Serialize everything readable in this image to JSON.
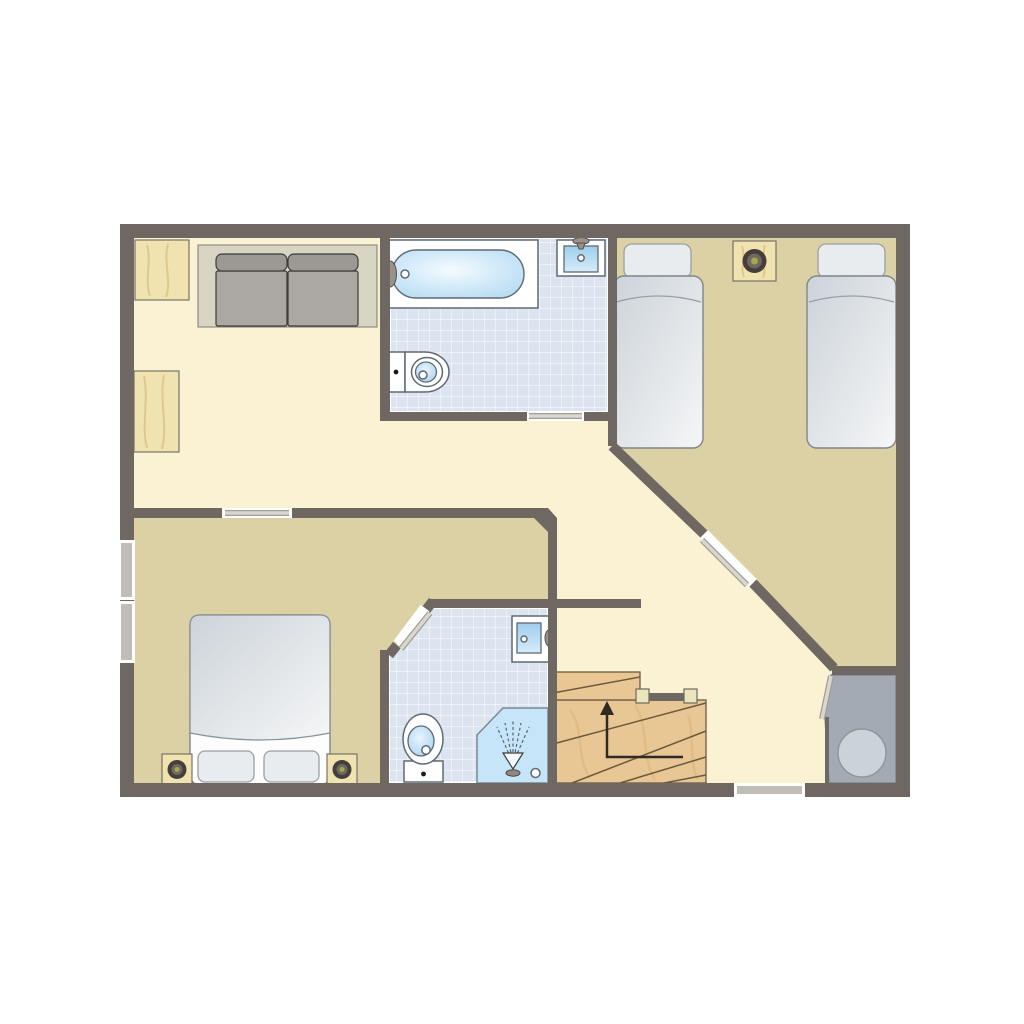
{
  "diagram": {
    "type": "floor-plan",
    "label": "apartment-floor-plan",
    "visible_text": "none"
  },
  "palette": {
    "background": "#ffffff",
    "wall": "#6f6862",
    "floor_hall": "#fbf2d3",
    "floor_bedroom": "#dcd1a5",
    "floor_bath_tile": "#dce4f0",
    "floor_utility": "#a2abb4",
    "stair_wood": "#e8c795",
    "stair_grain": "#d9b478",
    "stair_edge": "#6b5a3e",
    "furniture_wood": "#f0e3b0",
    "furniture_wood_grain": "#d9c084",
    "sofa_base": "#d9d5c5",
    "sofa_cushion": "#aba7a3",
    "sofa_cushion_back": "#9c9894",
    "sofa_outline": "#3e3b38",
    "bed_duvet_dark": "#ccd3d9",
    "bed_duvet_light": "#f5f6f7",
    "bed_outline": "#7e858b",
    "pillow_fill": "#e9ecef",
    "fixture_outline": "#5f6a73",
    "water_blue": "#b9ddf4",
    "water_blue_light": "#f4fbff",
    "door_leaf": "#dad6d0",
    "window_glass": "#c0bcb7",
    "utility_circle": "#ccd3d8",
    "arrow": "#2e2a26",
    "speaker_dark": "#443f3a",
    "speaker_mid": "#6e6a63",
    "speaker_center": "#a7a64b"
  },
  "rooms": {
    "living": {
      "label": "living-area",
      "floor": "cream",
      "items": [
        "sideboard",
        "cabinet",
        "sofa"
      ]
    },
    "hall": {
      "label": "hallway",
      "floor": "cream",
      "items": [
        "staircase"
      ]
    },
    "bath_top": {
      "label": "bathroom",
      "floor": "tiles",
      "items": [
        "bathtub",
        "washbasin",
        "toilet"
      ]
    },
    "bed_right": {
      "label": "twin-bedroom",
      "floor": "tan",
      "items": [
        "single-bed",
        "single-bed",
        "speaker-table"
      ]
    },
    "bed_left": {
      "label": "double-bedroom",
      "floor": "tan",
      "items": [
        "double-bed",
        "floor-speaker",
        "floor-speaker"
      ]
    },
    "bath_low": {
      "label": "shower-room",
      "floor": "tiles",
      "items": [
        "toilet",
        "washbasin",
        "shower"
      ]
    },
    "utility": {
      "label": "utility-room",
      "floor": "gray",
      "items": [
        "round-tank"
      ]
    }
  },
  "stairs": {
    "label": "winder-staircase",
    "direction": "up",
    "tread_lines": 5,
    "railing_posts": 2
  },
  "openings": {
    "window_count": 3,
    "windows": [
      {
        "wall": "left",
        "position": "upper"
      },
      {
        "wall": "left",
        "position": "lower"
      },
      {
        "wall": "bottom",
        "position": "right-of-stairs"
      }
    ],
    "door_count": 5,
    "doors": [
      {
        "to": "double-bedroom"
      },
      {
        "to": "bathroom"
      },
      {
        "to": "twin-bedroom"
      },
      {
        "to": "shower-room"
      },
      {
        "to": "utility-room"
      }
    ]
  }
}
